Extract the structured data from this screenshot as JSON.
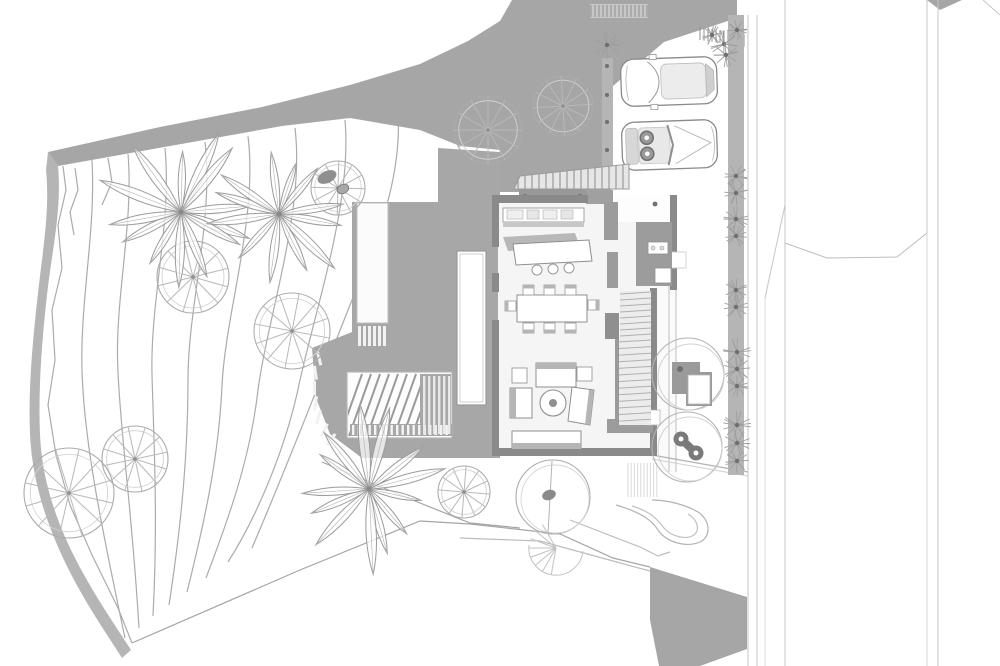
{
  "document": {
    "type": "architectural-site-plan-top-view",
    "style": "black and white presentation drawing",
    "visible_text": "none"
  },
  "palette": {
    "background": "#ffffff",
    "band_gray": "#a6a6a6",
    "band_soft": "#b5b5b5",
    "deck_gray": "#a7a7a7",
    "wall_gray": "#8a8a8a",
    "room_gray": "#9c9c9c",
    "shadow_gray": "#c7c7c7",
    "floor_light": "#f5f5f5",
    "terrace_light": "#fafafa",
    "stair_light": "#ececec",
    "contour_line": "#ababab",
    "outline": "#8f8f8f",
    "parcel_line": "#c6c6c6",
    "hatch_line": "#9a9a9a",
    "dark_accent": "#6f6f6f",
    "white": "#ffffff"
  },
  "scene": {
    "site": {
      "hillside_contour_lines": 11,
      "boundary_band": "gray road/retaining band sweeping from upper right to left tip, then down the left edge",
      "parcel_lines_right": 6,
      "bottom_right_gray_wedge": 1
    },
    "house": {
      "rooms": [
        "kitchen with counter and island",
        "dining area 8 seats",
        "living area with sofas and round table",
        "two staircase flights",
        "utility rooms",
        "entry walkway"
      ],
      "outdoor": [
        "entry steps",
        "lap pool strip",
        "wood deck with railing and stairs",
        "right terrace with planters"
      ]
    },
    "vehicles": [
      "suv-top-view",
      "convertible-top-view"
    ],
    "vegetation": {
      "palm_trees": 3,
      "spoked_canopy_trees": 8,
      "canopy_circle_trees": 3,
      "shrub_clusters": 17,
      "boulder_pebbles": 2,
      "spa_barbell_rocks": 1
    }
  }
}
